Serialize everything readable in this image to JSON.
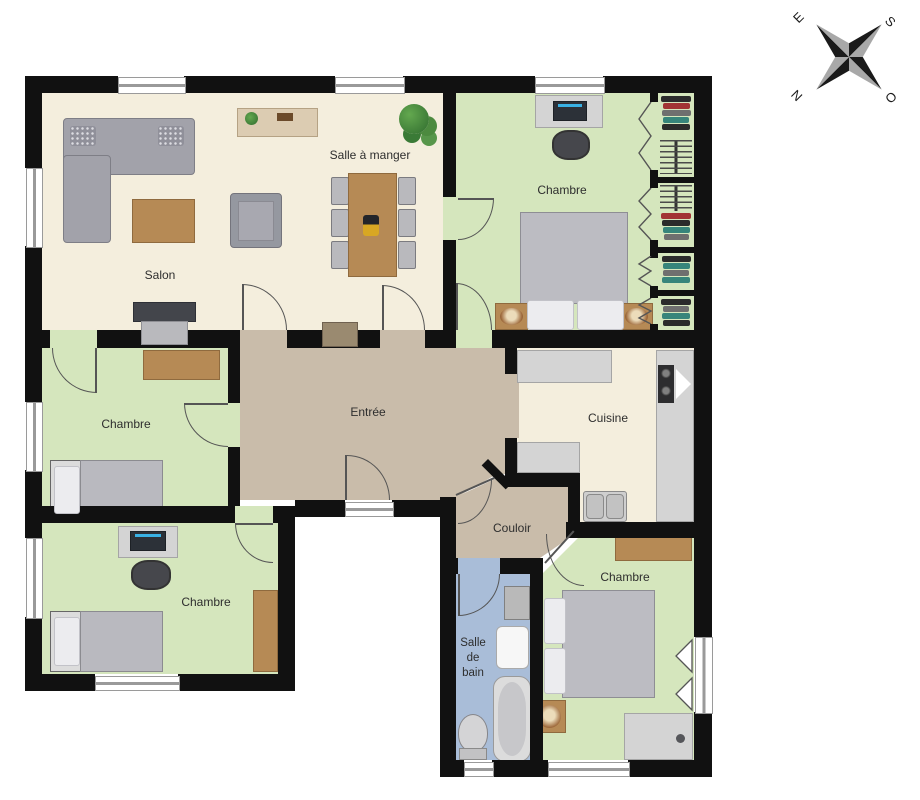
{
  "compass": {
    "e": "E",
    "s": "S",
    "n": "N",
    "o": "O"
  },
  "rooms": {
    "salon": {
      "label": "Salon"
    },
    "salle_a_manger": {
      "label": "Salle à manger"
    },
    "chambre_nord_est": {
      "label": "Chambre"
    },
    "chambre_ouest": {
      "label": "Chambre"
    },
    "chambre_sud_ouest": {
      "label": "Chambre"
    },
    "chambre_sud_est": {
      "label": "Chambre"
    },
    "entree": {
      "label": "Entrée"
    },
    "cuisine": {
      "label": "Cuisine"
    },
    "couloir": {
      "label": "Couloir"
    },
    "salle_de_bain": {
      "label": "Salle de bain"
    }
  },
  "palette": {
    "wall": "#111111",
    "floor_cream": "#f4eedd",
    "floor_green": "#d5e6bd",
    "floor_tan": "#c9bcaa",
    "floor_blue": "#a9bdd8",
    "wood": "#b68a55",
    "wood_dark": "#8f6a3e",
    "counter": "#d4d4d4",
    "window_line": "#9a9a9a",
    "door": "#555555",
    "text": "#2e2e2e",
    "cl1": "#2b2b2b",
    "cl2": "#a23434",
    "cl3": "#37857b",
    "cl4": "#6f6f6f",
    "cl5": "#3f6e46"
  }
}
